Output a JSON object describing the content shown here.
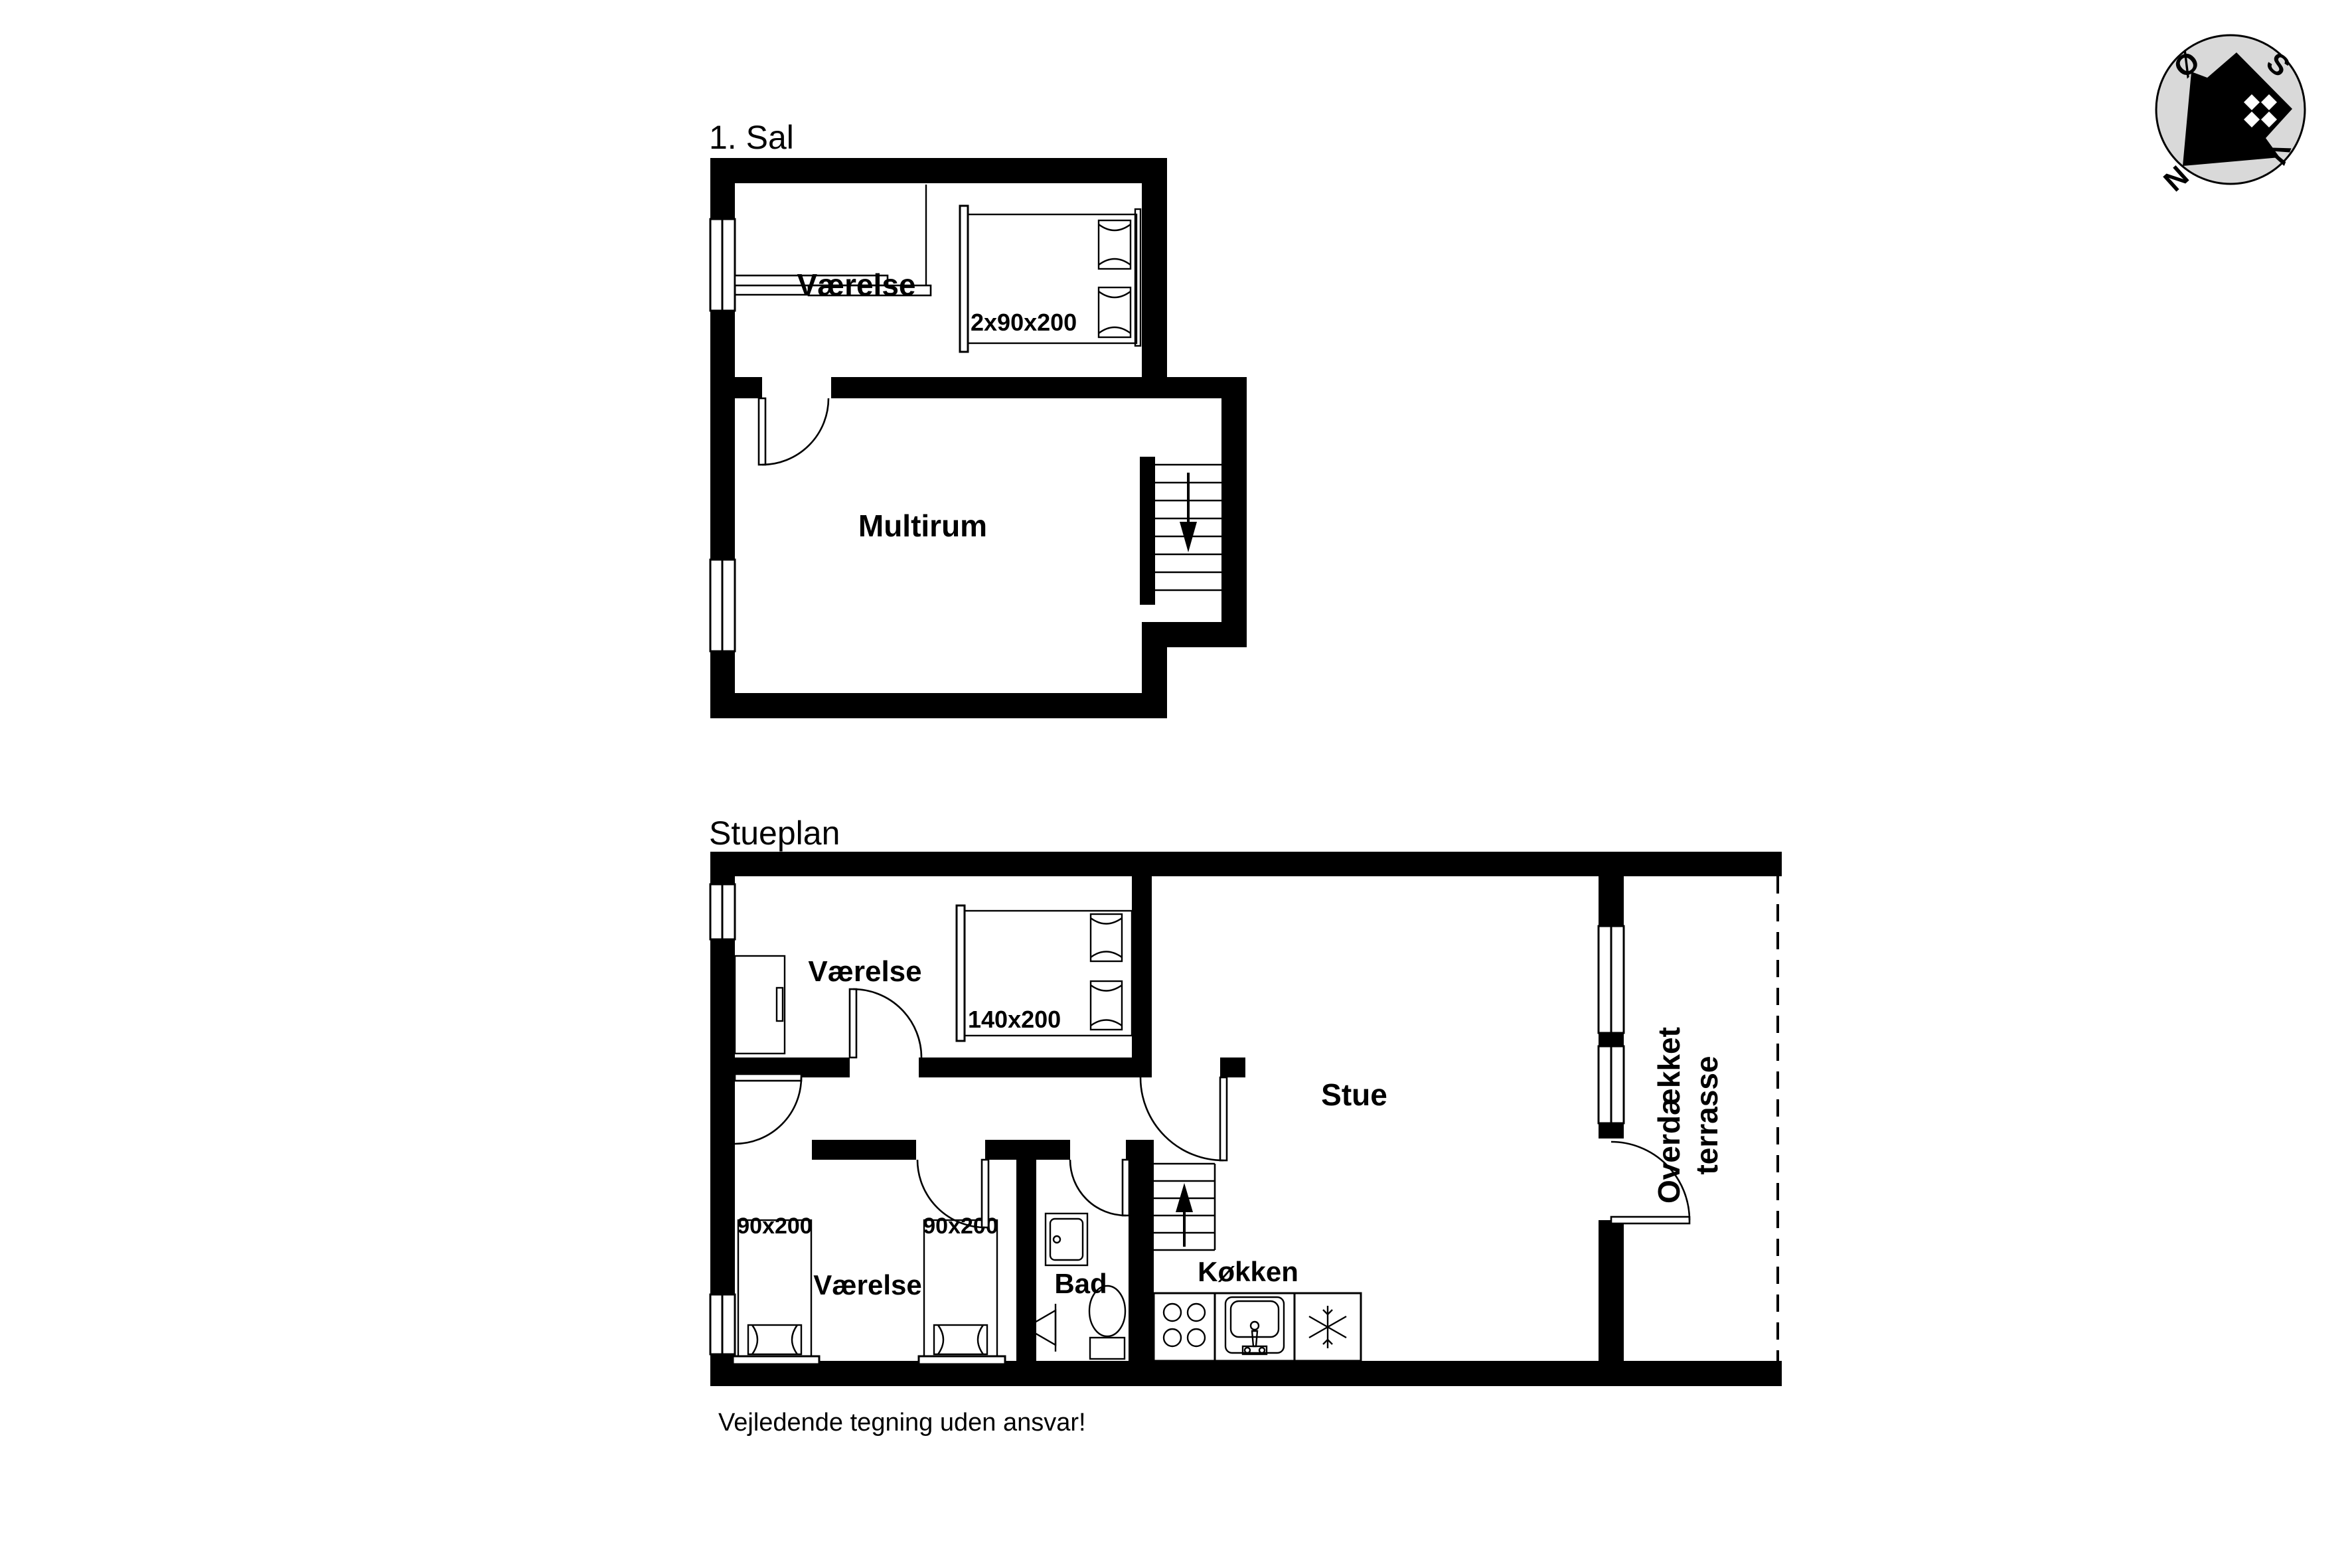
{
  "page": {
    "background": "#ffffff",
    "ink": "#000000",
    "compass_circle_color": "#d9d9d9"
  },
  "floor_upper": {
    "title": "1. Sal",
    "bedroom_label": "Værelse",
    "bedroom_bed_label": "2x90x200",
    "multiroom_label": "Multirum"
  },
  "floor_ground": {
    "title": "Stueplan",
    "bedroom_top_label": "Værelse",
    "bedroom_top_bed_label": "140x200",
    "living_label": "Stue",
    "bedroom_bottom_label": "Værelse",
    "bedroom_bottom_bed1_label": "90x200",
    "bedroom_bottom_bed2_label": "90x200",
    "bath_label": "Bad",
    "kitchen_label": "Køkken",
    "terrace_label_line1": "Overdækket",
    "terrace_label_line2": "terrasse"
  },
  "compass": {
    "north": "N",
    "south": "S",
    "east": "Ø",
    "west": "V"
  },
  "footer": {
    "disclaimer": "Vejledende tegning uden ansvar!"
  }
}
